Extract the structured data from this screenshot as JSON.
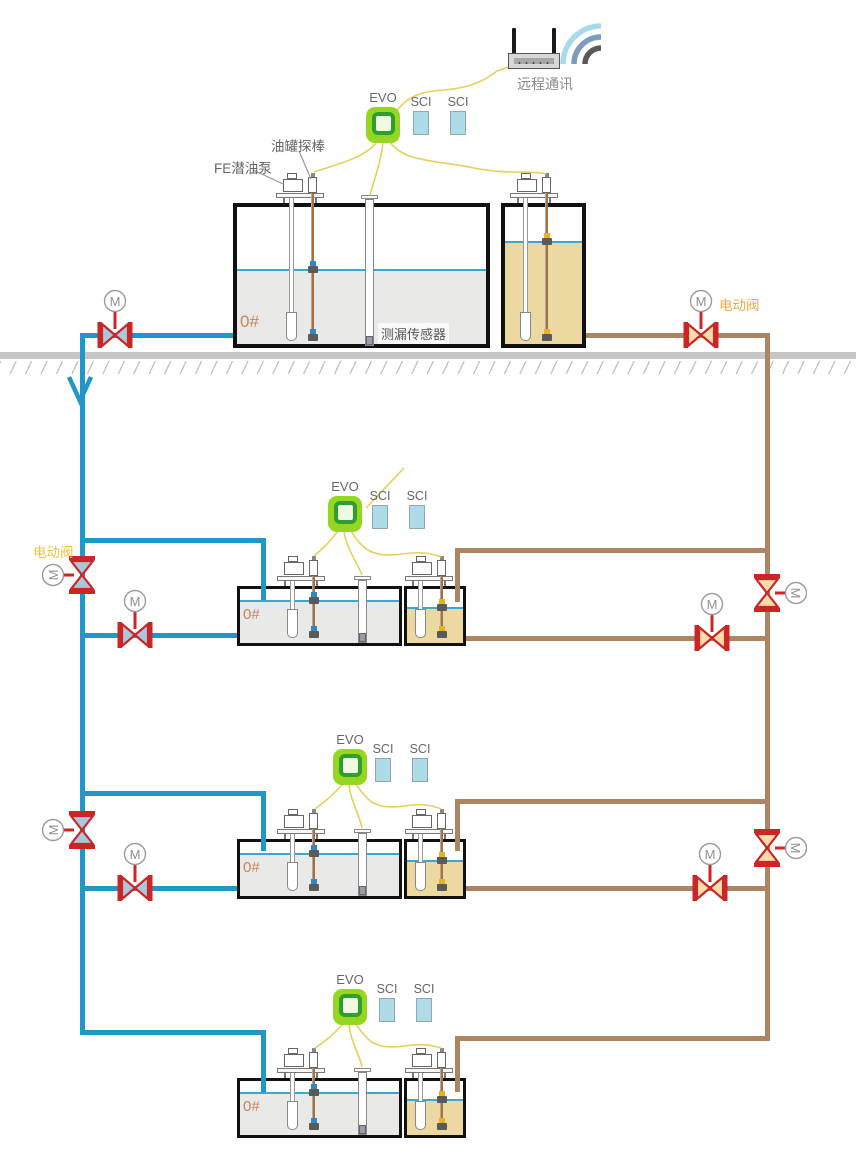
{
  "colors": {
    "pipe_blue": "#2196c9",
    "pipe_brown": "#ae8562",
    "valve_red": "#cc2525",
    "valve_disc_blue": "#a9c7dd",
    "valve_disc_cream": "#f6ddab",
    "wire_yellow": "#e8cf5a",
    "evo_green": "#95d621",
    "evo_ring_green": "#2f9e2f",
    "sci_box_blue": "#aedbe8",
    "tank_liquid_gray": "#e9e9e7",
    "tank_liquid_tan": "#ecd9a2",
    "liquid_line_blue": "#3aa7d0",
    "ground_gray": "#c6c6c6",
    "label_orange": "#efa94a",
    "label_yellow": "#ecc23f",
    "tank_number_orange": "#c8845a"
  },
  "router": {
    "label": "远程通讯"
  },
  "controller": {
    "evo_label": "EVO",
    "sci_label": "SCI"
  },
  "valves": {
    "motor_letter": "M",
    "electric_valve_label": "电动阀"
  },
  "surface_station": {
    "tank_number": "0#",
    "pump_label": "FE潜油泵",
    "probe_label": "油罐探棒",
    "leak_sensor_label": "测漏传感器"
  },
  "underground_stations": [
    {
      "tank_number": "0#"
    },
    {
      "tank_number": "0#"
    },
    {
      "tank_number": "0#"
    }
  ]
}
